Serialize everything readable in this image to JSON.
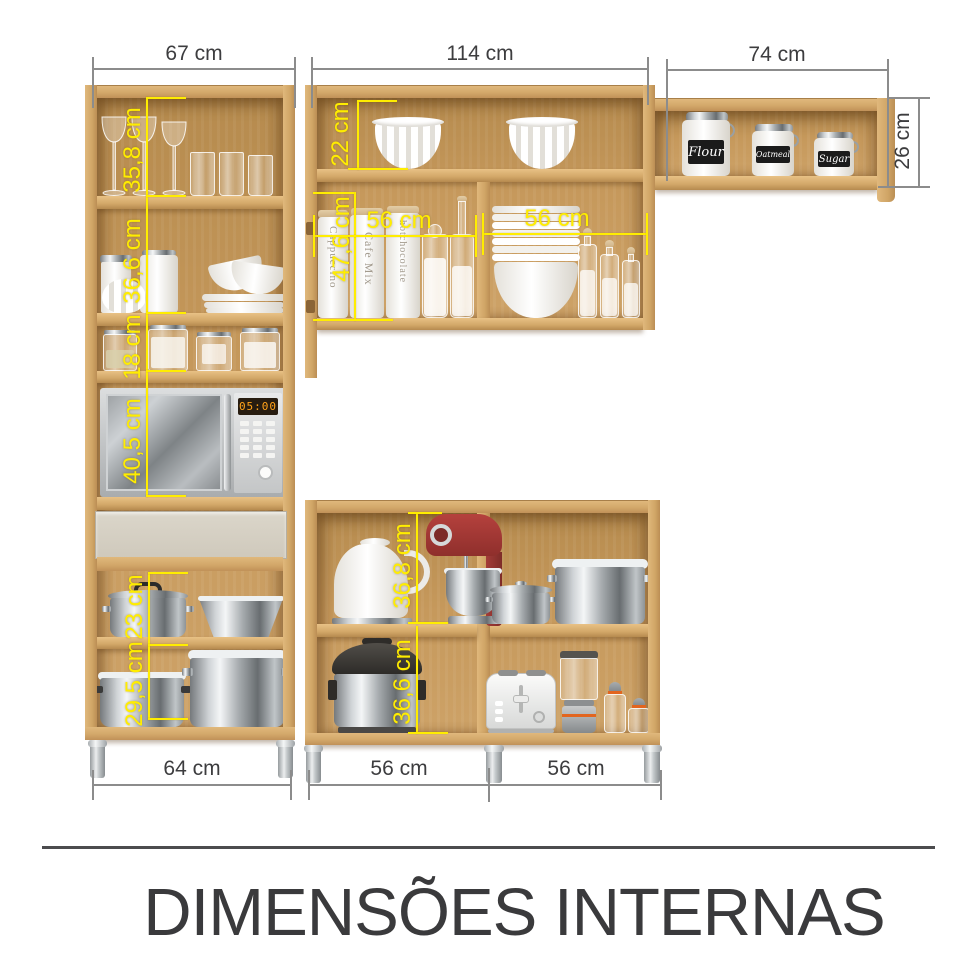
{
  "title": {
    "text": "DIMENSÕES INTERNAS"
  },
  "colors": {
    "accent_yellow": "#ffed00",
    "dimension_text": "#3d3d3f",
    "wood_front": "#d6ab6e",
    "wood_interior": "#c2975a",
    "drawer_front": "#d4cfc3"
  },
  "dimensions": {
    "top": [
      {
        "label": "67 cm"
      },
      {
        "label": "114 cm"
      },
      {
        "label": "74 cm"
      }
    ],
    "right": {
      "label": "26 cm"
    },
    "bottom": [
      {
        "label": "64 cm"
      },
      {
        "label": "56 cm"
      },
      {
        "label": "56 cm"
      }
    ],
    "internal": [
      {
        "label": "35,8 cm"
      },
      {
        "label": "36,6 cm"
      },
      {
        "label": "18 cm"
      },
      {
        "label": "40,5 cm"
      },
      {
        "label": "22 cm"
      },
      {
        "label": "47,6 cm"
      },
      {
        "label": "56 cm"
      },
      {
        "label": "56 cm"
      },
      {
        "label": "23 cm"
      },
      {
        "label": "29,5 cm"
      },
      {
        "label": "36,8 cm"
      },
      {
        "label": "36,6 cm"
      }
    ]
  },
  "items": {
    "pantry_canisters": [
      {
        "label": "Cappuccino"
      },
      {
        "label": "Cafe Mix"
      },
      {
        "label": "hotchocolate"
      }
    ],
    "shelf_jars": [
      {
        "label": "Flour"
      },
      {
        "label": "Oatmeal"
      },
      {
        "label": "Sugar"
      }
    ],
    "microwave_display": "05:00"
  }
}
